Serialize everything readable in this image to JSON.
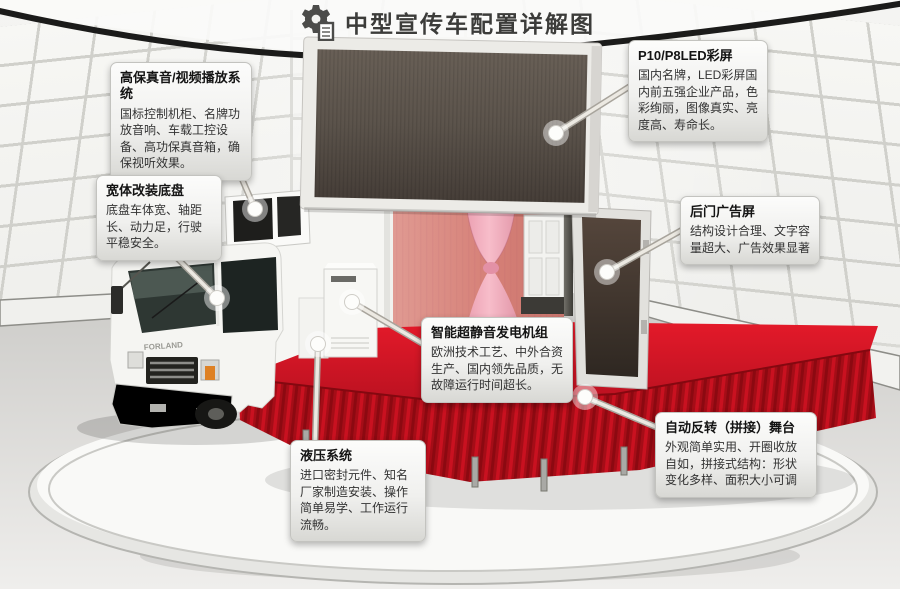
{
  "header": {
    "title": "中型宣传车配置详解图",
    "icon": "gear-document-icon"
  },
  "scene": {
    "truck_brand": "FORLAND",
    "colors": {
      "stage_red": "#c8101e",
      "stage_skirt_red": "#a50d17",
      "curtain_pink": "#e8a0b0",
      "backdrop_salmon": "#d98880",
      "led_screen_dark": "#57504a",
      "wall_panel": "#f3f3f0",
      "callout_face": "#efefed",
      "marker_dot": "#ffffff"
    }
  },
  "callouts": [
    {
      "id": "audio",
      "title": "高保真音/视频播放系统",
      "body": "国标控制机柜、名牌功放音响、车载工控设备、高功保真音箱，确保视听效果。"
    },
    {
      "id": "chassis",
      "title": "宽体改装底盘",
      "body": "底盘车体宽、轴距长、动力足，行驶平稳安全。"
    },
    {
      "id": "led",
      "title": "P10/P8LED彩屏",
      "body": "国内名牌，LED彩屏国内前五强企业产品，色彩绚丽，图像真实、亮度高、寿命长。"
    },
    {
      "id": "reardoor",
      "title": "后门广告屏",
      "body": "结构设计合理、文字容量超大、广告效果显著"
    },
    {
      "id": "generator",
      "title": "智能超静音发电机组",
      "body": "欧洲技术工艺、中外合资生产、国内领先品质，无故障运行时间超长。"
    },
    {
      "id": "hydraulic",
      "title": "液压系统",
      "body": "进口密封元件、知名厂家制造安装、操作简单易学、工作运行流畅。"
    },
    {
      "id": "stage",
      "title": "自动反转（拼接）舞台",
      "body": "外观简单实用、开圈收放自如，拼接式结构：形状变化多样、面积大小可调"
    }
  ]
}
